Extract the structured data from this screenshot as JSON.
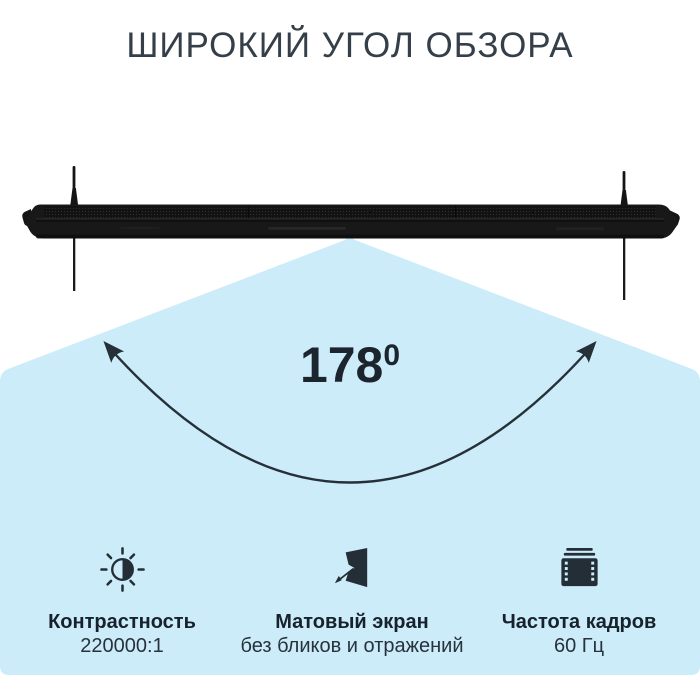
{
  "title": "ШИРОКИЙ УГОЛ ОБЗОРА",
  "diagram": {
    "angle": {
      "value": "178",
      "superscript": "0"
    },
    "illustration": "tv-top-view",
    "cone": "viewing-angle-cone",
    "arc": "angle-arc-with-arrows"
  },
  "features": [
    {
      "icon": "contrast-icon",
      "label": "Контрастность",
      "value": "220000:1"
    },
    {
      "icon": "matte-screen-icon",
      "label": "Матовый экран",
      "value": "без бликов и отражений"
    },
    {
      "icon": "frame-rate-icon",
      "label": "Частота кадров",
      "value": "60 Гц"
    }
  ],
  "colors": {
    "background": "#ffffff",
    "cone_fill": "#cdecfa",
    "tv_body": "#181818",
    "heading_text": "#353f49",
    "label_text": "#17222c",
    "arc_stroke": "#263039"
  }
}
